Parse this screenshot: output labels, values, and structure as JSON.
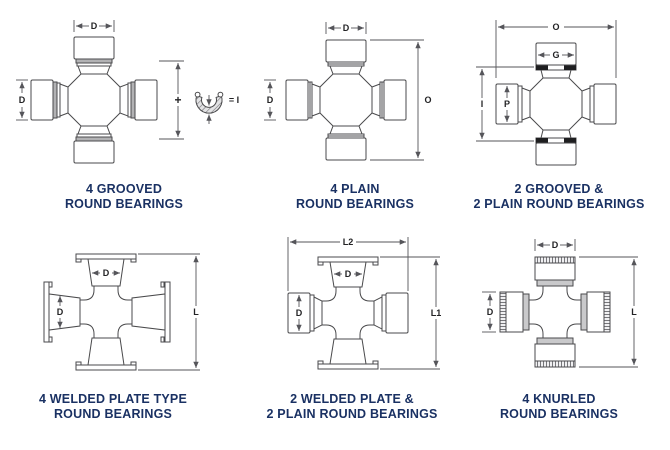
{
  "page": {
    "background": "#ffffff"
  },
  "colors": {
    "line": "#4a4a4c",
    "caption_navy": "#1a3163",
    "dim_label": "#232325",
    "groove_gray": "#b2b2b4",
    "knurl_band_gray": "#c9c9cb",
    "snap_ring_black": "#1e1e20"
  },
  "diagrams": [
    {
      "id": "grooved-4",
      "caption": [
        "4 GROOVED",
        "ROUND BEARINGS"
      ],
      "dims": {
        "top": "D",
        "left": "D",
        "plus": "+",
        "ring_eq": "= I"
      }
    },
    {
      "id": "plain-4",
      "caption": [
        "4 PLAIN",
        "ROUND BEARINGS"
      ],
      "dims": {
        "top": "D",
        "left": "D",
        "right": "O"
      }
    },
    {
      "id": "grooved-2-plain-2",
      "caption": [
        "2 GROOVED &",
        "2 PLAIN ROUND BEARINGS"
      ],
      "dims": {
        "top_span": "O",
        "cap_top": "G",
        "left_span": "I",
        "cap_left": "P"
      }
    },
    {
      "id": "welded-plate-4",
      "caption": [
        "4 WELDED PLATE TYPE",
        "ROUND BEARINGS"
      ],
      "dims": {
        "cap_top": "D",
        "cap_left": "D",
        "right": "L"
      }
    },
    {
      "id": "welded-2-plain-2",
      "caption": [
        "2 WELDED PLATE &",
        "2 PLAIN ROUND BEARINGS"
      ],
      "dims": {
        "top_span": "L2",
        "cap_top": "D",
        "cap_left": "D",
        "right": "L1"
      }
    },
    {
      "id": "knurled-4",
      "caption": [
        "4 KNURLED",
        "ROUND BEARINGS"
      ],
      "dims": {
        "top": "D",
        "left": "D",
        "right": "L"
      }
    }
  ]
}
